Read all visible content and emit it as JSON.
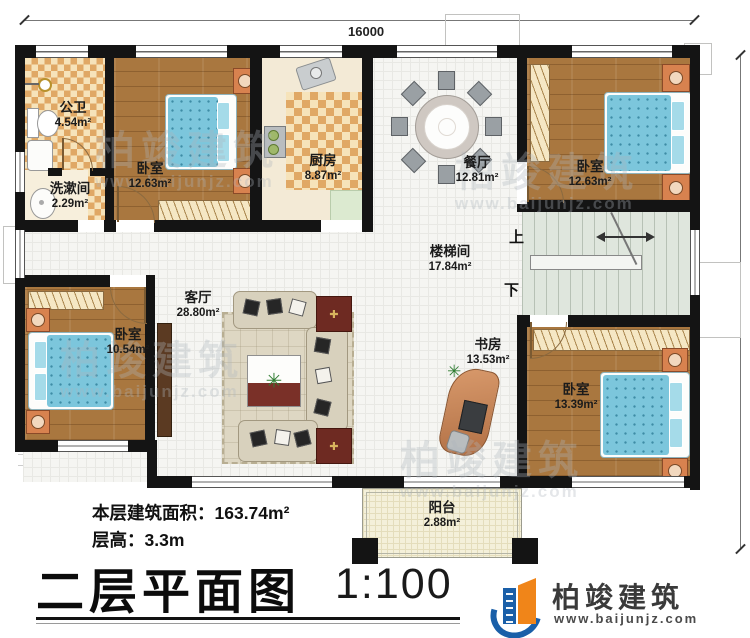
{
  "dimensions": {
    "top": "16000",
    "right": "11800"
  },
  "rooms": [
    {
      "id": "bath",
      "name": "公卫",
      "area": "4.54m²"
    },
    {
      "id": "washroom",
      "name": "洗漱间",
      "area": "2.29m²"
    },
    {
      "id": "bedroom-tl",
      "name": "卧室",
      "area": "12.63m²"
    },
    {
      "id": "kitchen",
      "name": "厨房",
      "area": "8.87m²"
    },
    {
      "id": "dining",
      "name": "餐厅",
      "area": "12.81m²"
    },
    {
      "id": "bedroom-tr",
      "name": "卧室",
      "area": "12.63m²"
    },
    {
      "id": "stairwell",
      "name": "楼梯间",
      "area": "17.84m²"
    },
    {
      "id": "living",
      "name": "客厅",
      "area": "28.80m²"
    },
    {
      "id": "bedroom-bl",
      "name": "卧室",
      "area": "10.54m²"
    },
    {
      "id": "study",
      "name": "书房",
      "area": "13.53m²"
    },
    {
      "id": "bedroom-br",
      "name": "卧室",
      "area": "13.39m²"
    },
    {
      "id": "balcony",
      "name": "阳台",
      "area": "2.88m²"
    }
  ],
  "stairs": {
    "up": "上",
    "down": "下"
  },
  "footer": {
    "floor_area_label": "本层建筑面积：",
    "floor_area_value": "163.74m²",
    "floor_height_label": "层高：",
    "floor_height_value": "3.3m",
    "title": "二层平面图",
    "scale": "1:100"
  },
  "logo": {
    "name": "柏竣建筑",
    "url": "www.baijunjz.com"
  },
  "watermark": {
    "name": "柏竣建筑",
    "url": "www.baijunjz.com"
  },
  "colors": {
    "wall": "#141414",
    "wood_floor": "#a9773f",
    "bed": "#7cc6dc",
    "checker": "#e0a865",
    "stair": "#dfe6dd",
    "balcony": "#f4f0da",
    "logo_blue": "#1a5fa8",
    "logo_orange": "#f08519",
    "side_table": "#6e2a22"
  }
}
